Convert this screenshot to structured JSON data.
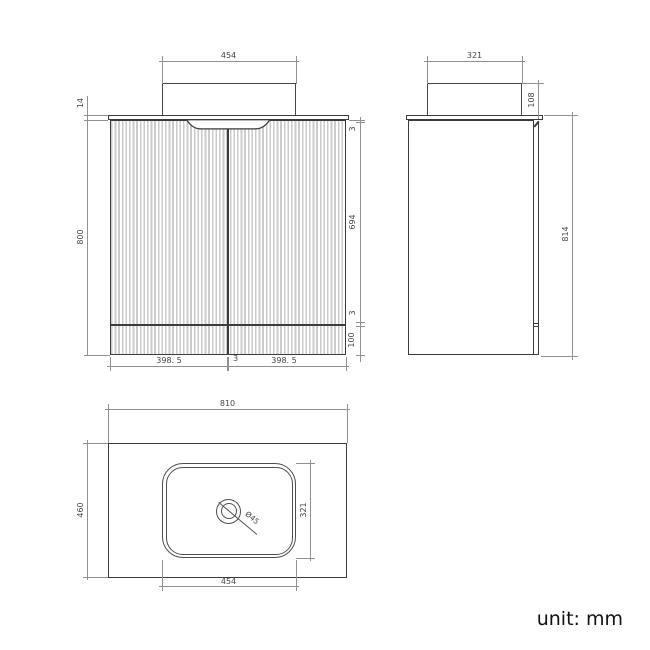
{
  "meta": {
    "unit_label": "unit: mm"
  },
  "colors": {
    "outline": "#3c3c3c",
    "dimension_line": "#919191",
    "dimension_text": "#464646",
    "flute_stripe": "#cbcbcb",
    "background": "#ffffff"
  },
  "front_view": {
    "description": "front elevation of fluted vanity cabinet with basin",
    "dims": {
      "basin_width": "454",
      "countertop_thickness": "14",
      "cabinet_height": "800",
      "top_gap": "3",
      "door_height": "694",
      "bottom_gap": "3",
      "plinth_height": "100",
      "door_width_left": "398. 5",
      "center_gap": "3",
      "door_width_right": "398. 5"
    }
  },
  "side_view": {
    "description": "side elevation",
    "dims": {
      "basin_depth": "321",
      "basin_height": "108",
      "total_height": "814"
    }
  },
  "plan_view": {
    "description": "top plan view of countertop with inset basin and drain",
    "dims": {
      "countertop_width": "810",
      "countertop_depth": "460",
      "basin_depth": "321",
      "basin_width": "454",
      "drain_diameter": "Ø45"
    }
  }
}
